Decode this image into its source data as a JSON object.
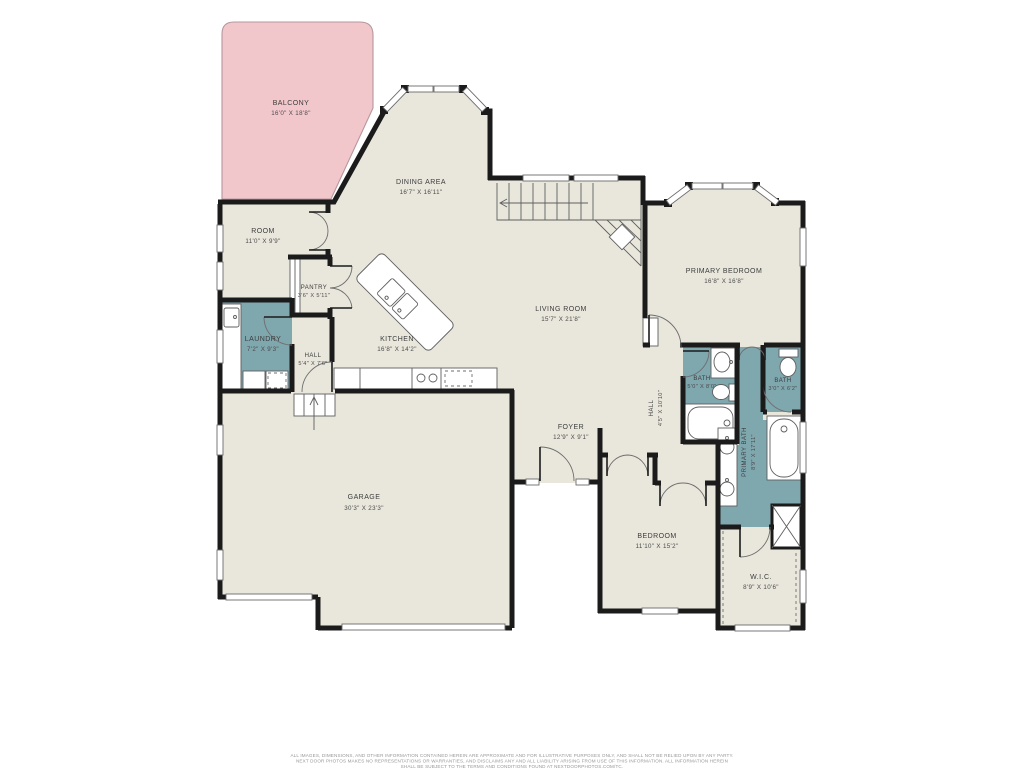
{
  "colors": {
    "floor": "#e9e7dc",
    "balcony": "#f2c7cc",
    "wet_room": "#7fa7ae",
    "wall": "#1b1b1b",
    "background": "#ffffff"
  },
  "rooms": {
    "balcony": {
      "name": "BALCONY",
      "dims": "16'0\" X 18'8\""
    },
    "dining": {
      "name": "DINING AREA",
      "dims": "16'7\" X 16'11\""
    },
    "room": {
      "name": "ROOM",
      "dims": "11'0\" X 9'9\""
    },
    "pantry": {
      "name": "PANTRY",
      "dims": "3'6\" X 5'11\""
    },
    "laundry": {
      "name": "LAUNDRY",
      "dims": "7'2\" X 9'3\""
    },
    "hall_small": {
      "name": "HALL",
      "dims": "5'4\" X 7'6\""
    },
    "kitchen": {
      "name": "KITCHEN",
      "dims": "16'8\" X 14'2\""
    },
    "living": {
      "name": "LIVING ROOM",
      "dims": "15'7\" X 21'8\""
    },
    "primary_bedroom": {
      "name": "PRIMARY BEDROOM",
      "dims": "16'8\" X 16'8\""
    },
    "bath1": {
      "name": "BATH",
      "dims": "5'0\" X 8'0\""
    },
    "bath2": {
      "name": "BATH",
      "dims": "3'0\" X 6'2\""
    },
    "hall_vertical": {
      "name": "HALL",
      "dims": "4'5\" X 10'10\""
    },
    "primary_bath": {
      "name": "PRIMARY BATH",
      "dims": "8'9\" X 17'11\""
    },
    "foyer": {
      "name": "FOYER",
      "dims": "12'9\" X 9'1\""
    },
    "garage": {
      "name": "GARAGE",
      "dims": "30'3\" X 23'3\""
    },
    "bedroom": {
      "name": "BEDROOM",
      "dims": "11'10\" X 15'2\""
    },
    "wic": {
      "name": "W.I.C.",
      "dims": "8'9\" X 10'6\""
    }
  },
  "footer": {
    "line1": "ALL IMAGES, DIMENSIONS, AND OTHER INFORMATION CONTAINED HEREIN ARE APPROXIMATE AND FOR ILLUSTRATIVE PURPOSES ONLY, AND SHALL NOT BE RELIED UPON BY ANY PARTY.",
    "line2": "NEXT DOOR PHOTOS MAKES NO REPRESENTATIONS OR WARRANTIES, AND DISCLAIMS ANY AND ALL LIABILITY ARISING FROM USE OF THIS INFORMATION. ALL INFORMATION HEREIN",
    "line3": "SHALL BE SUBJECT TO THE TERMS AND CONDITIONS FOUND AT NEXTDOORPHOTOS.COM/TC."
  }
}
